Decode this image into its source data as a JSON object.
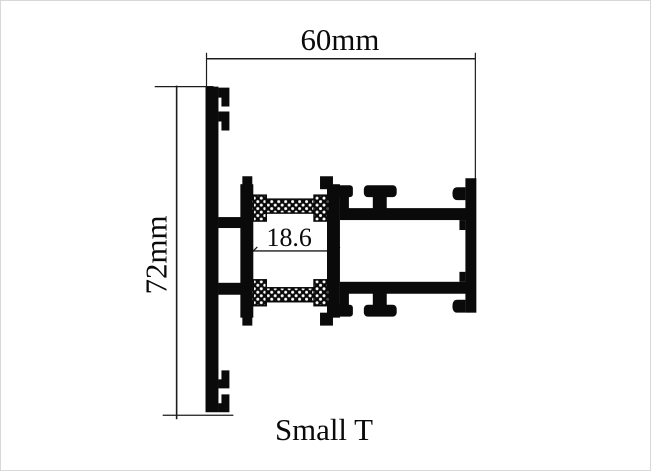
{
  "diagram": {
    "caption": "Small T",
    "profile_color": "#0a0a0a",
    "line_color": "#1c1c1c",
    "background_color": "#ffffff",
    "hatch_dot_color": "#ffffff",
    "dimensions": {
      "width": {
        "label": "60mm"
      },
      "height": {
        "label": "72mm"
      },
      "inner_width": {
        "label": "18.6"
      }
    }
  }
}
